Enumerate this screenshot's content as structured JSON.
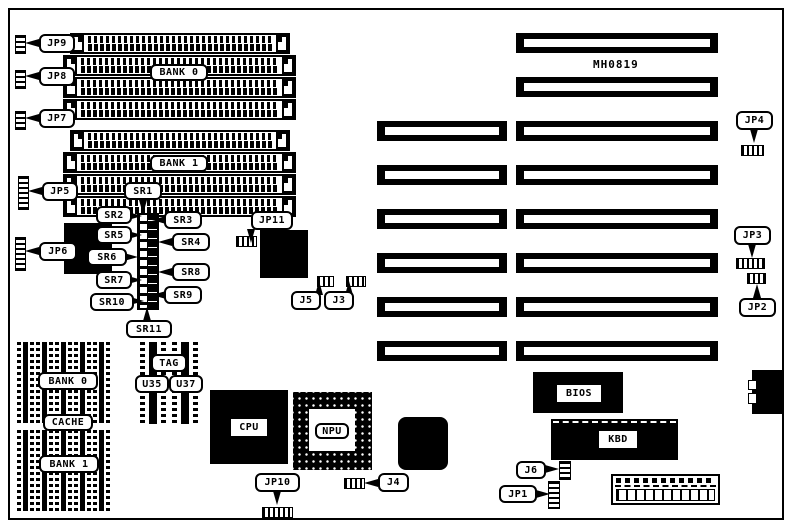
{
  "board": {
    "part_number": "MH0819",
    "ink_color": "#000000",
    "background_color": "#ffffff"
  },
  "memory": {
    "bank0": "BANK 0",
    "bank1": "BANK 1"
  },
  "cache": {
    "bank0": "BANK 0",
    "cache": "CACHE",
    "bank1": "BANK 1",
    "tag": "TAG",
    "u35": "U35",
    "u37": "U37"
  },
  "chips": {
    "cpu": "CPU",
    "npu": "NPU",
    "bios": "BIOS",
    "kbd": "KBD"
  },
  "jumpers": {
    "jp1": "JP1",
    "jp2": "JP2",
    "jp3": "JP3",
    "jp4": "JP4",
    "jp5": "JP5",
    "jp6": "JP6",
    "jp7": "JP7",
    "jp8": "JP8",
    "jp9": "JP9",
    "jp10": "JP10",
    "jp11": "JP11"
  },
  "connectors": {
    "j3": "J3",
    "j4": "J4",
    "j5": "J5",
    "j6": "J6"
  },
  "resistors": {
    "sr1": "SR1",
    "sr2": "SR2",
    "sr3": "SR3",
    "sr4": "SR4",
    "sr5": "SR5",
    "sr6": "SR6",
    "sr7": "SR7",
    "sr8": "SR8",
    "sr9": "SR9",
    "sr10": "SR10",
    "sr11": "SR11"
  }
}
